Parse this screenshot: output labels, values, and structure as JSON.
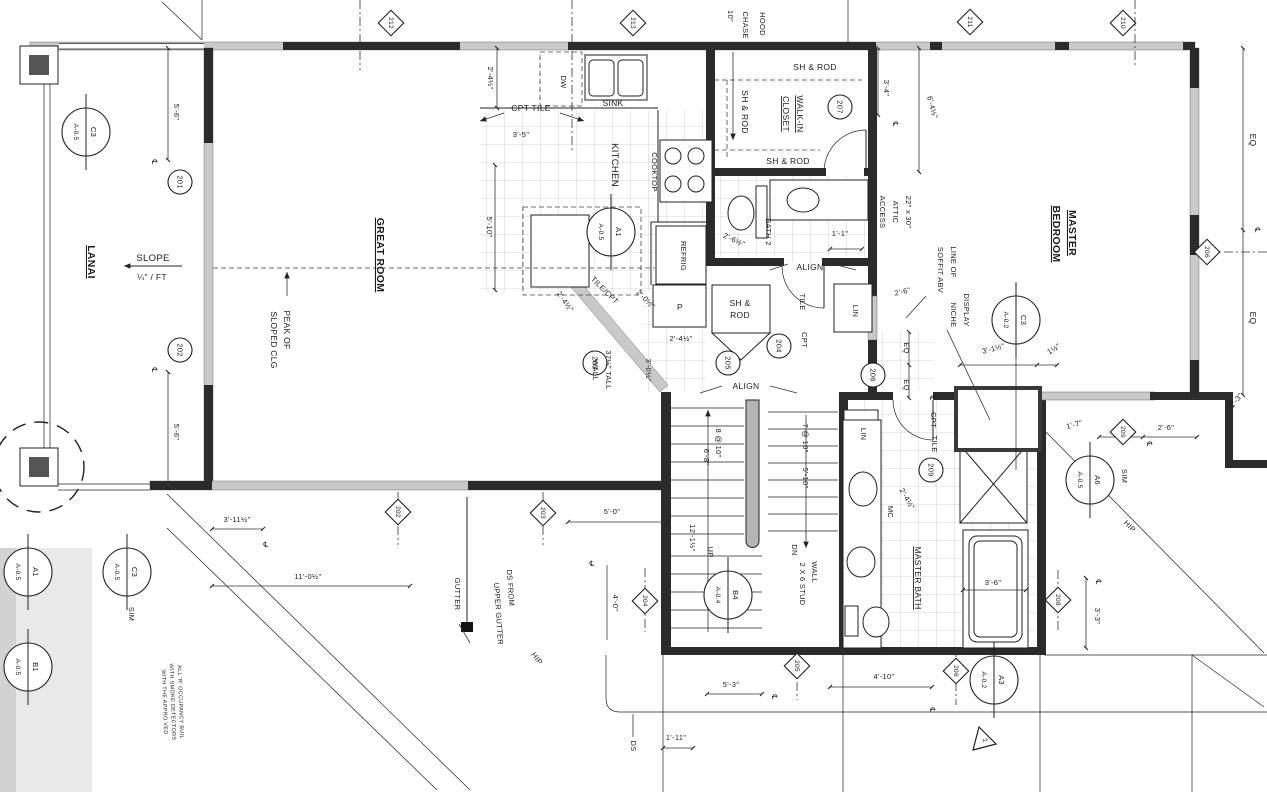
{
  "rooms": {
    "lanai": "LANAI",
    "great_room": "GREAT ROOM",
    "kitchen": "KITCHEN",
    "master": "MASTER",
    "bedroom": "BEDROOM",
    "walk_in": "WALK-IN",
    "closet": "CLOSET",
    "bath2": "BATH 2",
    "master_bath": "MASTER BATH",
    "pantry": "P",
    "lin": "LIN",
    "mc": "MC"
  },
  "fixtures": {
    "sink": "SINK",
    "dw": "DW",
    "cooktop": "COOKTOP",
    "refrig": "REFRIG",
    "hood": "HOOD",
    "chase": "CHASE",
    "ten_in": "10\"",
    "sh_rod": "SH & ROD",
    "sh": "SH &",
    "rod": "ROD"
  },
  "annotations": {
    "slope": "SLOPE",
    "slope_rate": "¼\" / FT",
    "peak1": "PEAK OF",
    "peak2": "SLOPED CLG",
    "attic1": "22\" x 30\"",
    "attic2": "ATTIC",
    "attic3": "ACCESS",
    "soffit1": "LINE OF",
    "soffit2": "SOFFIT ABV",
    "display1": "DISPLAY",
    "display2": "NICHE",
    "cpt_tile": "CPT TILE",
    "tile_cpt": "TILE/CPT",
    "tile": "TILE",
    "cpt": "CPT",
    "align": "ALIGN",
    "stud1": "2 X 6 STUD",
    "stud2": "WALL",
    "tall1": "37½\" TALL",
    "tall2": "WALL",
    "up": "UP",
    "dn": "DN",
    "run8": "8 @ 10\"",
    "run7": "7 @ 10\"",
    "eq": "EQ",
    "sim": "SIM",
    "gutter": "GUTTER",
    "ds": "DS",
    "ds_up1": "DS FROM",
    "ds_up2": "UPPER GUTTER",
    "hip": "HIP",
    "cl": "℄"
  },
  "dims": {
    "d5_6": "5'-6\"",
    "d2_4h": "2'-4½\"",
    "d3_5": "3'-5\"",
    "d5_10": "5'-10\"",
    "d6_8": "6'-8\"",
    "d3_4": "3'-4\"",
    "d6_4h": "6'-4½\"",
    "d1_1": "1'-1\"",
    "d2_6h": "2'-6½\"",
    "d2_6": "2'-6\"",
    "d3_1h": "3'-1½\"",
    "d1h": "1½\"",
    "d1_7": "1'-7\"",
    "d1_3": "1'-3\"",
    "d2_0h": "2'-0½\"",
    "d3_0h": "3'-0½\"",
    "d12_1h": "12'-1½\"",
    "d3_11h": "3'-11½\"",
    "d11_0h": "11'-0½\"",
    "d5_0": "5'-0\"",
    "d4_0": "4'-0\"",
    "d5_3": "5'-3\"",
    "d1_11": "1'-11\"",
    "d4_10": "4'-10\"",
    "d3_6": "3'-6\"",
    "d3_3": "3'-3\""
  },
  "tags": {
    "t201": "201",
    "t202": "202",
    "t203": "203",
    "t204": "204",
    "t205": "205",
    "t206": "206",
    "t207": "207",
    "t209": "209",
    "w202": "202",
    "w203": "203",
    "w204": "204",
    "w205": "205",
    "w206": "206",
    "w208": "208",
    "w209": "209",
    "w210": "210",
    "w211": "211",
    "w212": "212",
    "w213": "213"
  },
  "callouts": {
    "c3": "C3",
    "a1": "A1",
    "a3": "A3",
    "a6": "A6",
    "b1": "B1",
    "b4": "B4",
    "a02": "A-0.2",
    "a04": "A-0.4",
    "a05": "A-0.5"
  },
  "notes": {
    "l1": "ALL 'R' OCCUPANCY BUIL",
    "l2": "WITH SMOKE DETECTORS",
    "l3": "WITH THE APPRO VED",
    "rev": "2"
  }
}
